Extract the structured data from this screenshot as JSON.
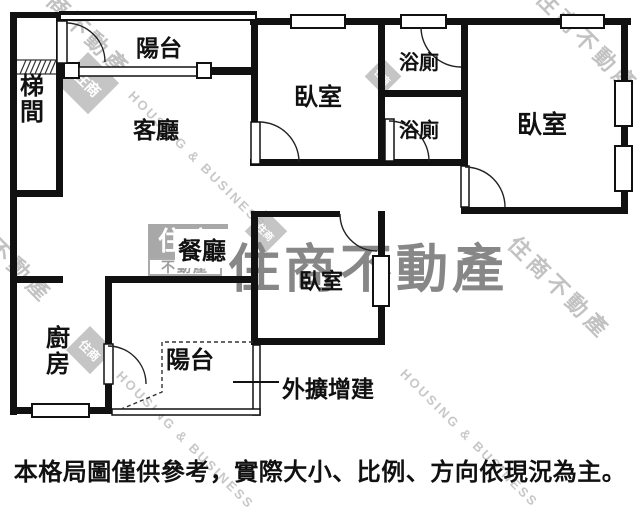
{
  "floorplan": {
    "labels": {
      "stairwell": "梯間",
      "balcony_top": "陽台",
      "living_room": "客廳",
      "bedroom_top_center": "臥室",
      "bathroom_upper": "浴廁",
      "bathroom_lower": "浴廁",
      "bedroom_right": "臥室",
      "dining_room": "餐廳",
      "bedroom_bottom_center": "臥室",
      "kitchen": "廚房",
      "balcony_bottom": "陽台",
      "annex_note": "外擴增建"
    },
    "disclaimer": "本格局圖僅供參考，實際大小、比例、方向依現況為主。"
  },
  "watermark": {
    "brand_zh": "住商不動產",
    "brand_en": "HOUSING & BUSINESS",
    "logo_top": "住商",
    "logo_bottom": "不動產",
    "logo_small": "住商"
  },
  "colors": {
    "wall": "#111111",
    "text": "#111111",
    "watermark_dark": "#878787",
    "watermark_light": "#c2c2c2",
    "background": "#ffffff"
  }
}
